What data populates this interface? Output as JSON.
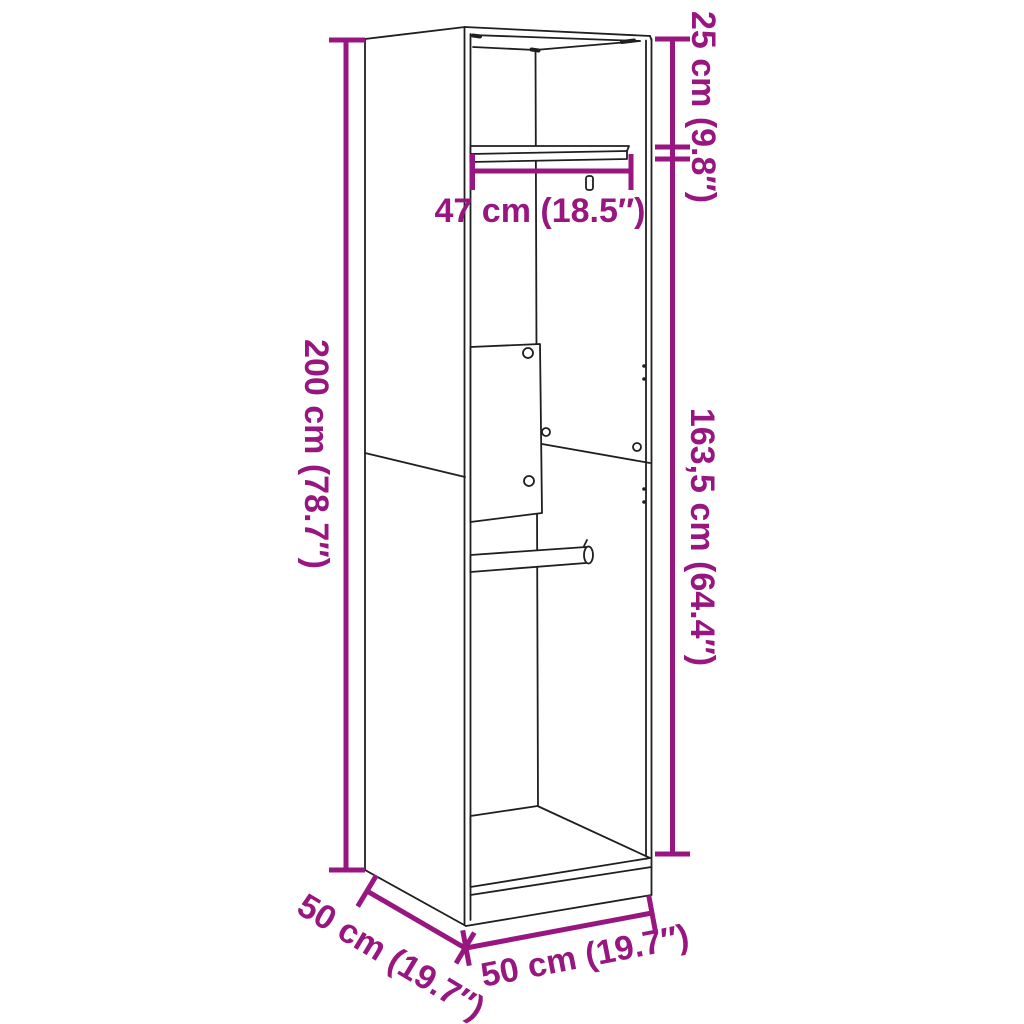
{
  "diagram": {
    "type": "product-dimension-diagram",
    "product": "wardrobe",
    "colors": {
      "dimension_annotation": "#971680",
      "outline": "#1f1f1f",
      "background": "#ffffff"
    },
    "labels": {
      "total_height": "200 cm (78.7″)",
      "top_section_height": "25 cm (9.8″)",
      "interior_height": "163,5 cm (64.4″)",
      "interior_width": "47 cm (18.5″)",
      "depth": "50 cm (19.7″)",
      "width": "50 cm (19.7″)"
    }
  }
}
